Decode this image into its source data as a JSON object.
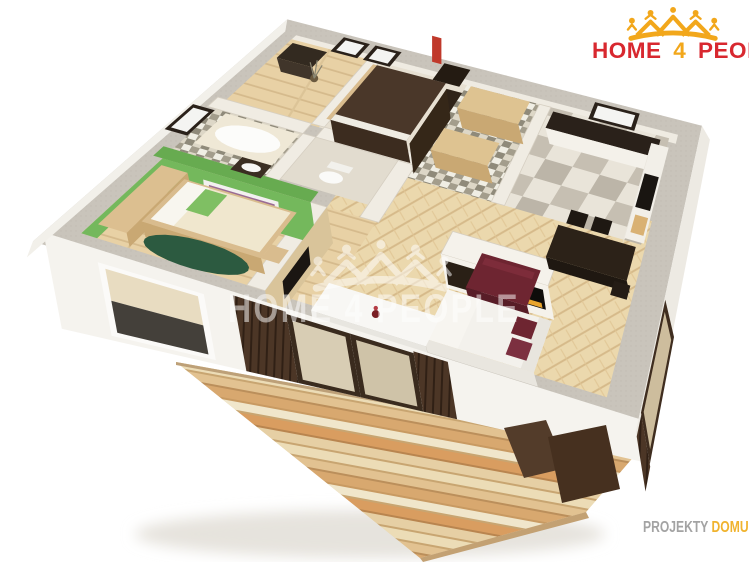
{
  "logo": {
    "word1": "HOME",
    "word2": "4",
    "word3": "PEOPLE",
    "icon": "crown-of-houses-and-people-icon"
  },
  "watermark": {
    "text": "HOME 4 PEOPLE",
    "icon": "crown-of-houses-and-people-icon"
  },
  "footer": {
    "part1": "PROJEKTY",
    "part2": "DOMU",
    "part3": "24.CZ"
  },
  "colors": {
    "logo_red": "#d8282f",
    "logo_gold": "#f2a71b",
    "footer_gray": "#a3a3a3",
    "footer_gold": "#f0b32e",
    "watermark_white": "#ffffff",
    "wall_gray": "#c9c4bb",
    "wall_cream": "#f0ece3",
    "facade_white": "#f5f3ee",
    "green_wall": "#67ab50",
    "green_light": "#74b85c",
    "rug_green": "#2c5a40",
    "parquet": "#ebd8ad",
    "parquet_line": "#d6ba8a",
    "wood_light": "#dec391",
    "wood_mid": "#c9a873",
    "dark_wood": "#3d2e22",
    "darker_wood": "#241c12",
    "slat_brown": "#4c3626",
    "burgundy": "#6e2531",
    "fire_glow": "#e8a42c",
    "chimney_red": "#c0392b",
    "checker_dark": "#bcb5a8",
    "checker_light": "#e9e4d9",
    "mosaic_dark": "#a39d8c",
    "mosaic_light": "#ddd7c7",
    "deck_base": "#e6cfa0",
    "bed_dark": "#4a3729",
    "mattress": "#f0e7ce"
  }
}
